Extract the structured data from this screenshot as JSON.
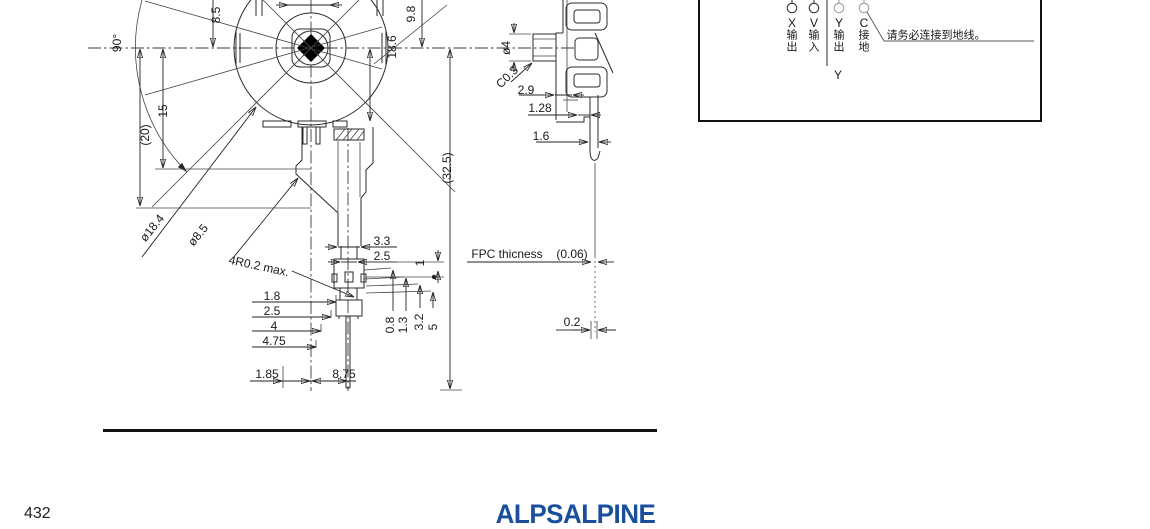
{
  "page": {
    "number": "432",
    "brand": "ALPSALPINE"
  },
  "front_view": {
    "dims": {
      "d85": "8.5",
      "a90": "90°",
      "d15": "15",
      "d20": "(20)",
      "dia1": "ø18.4",
      "dia2": "ø8.5",
      "d98": "9.8",
      "d186": "18.6",
      "d325": "(32.5)",
      "d33": "3.3",
      "d25a": "2.5",
      "r4": "4R0.2 max.",
      "d18": "1.8",
      "d25b": "2.5",
      "d4": "4",
      "d475": "4.75",
      "d185": "1.85",
      "d875": "8.75",
      "d1": "1",
      "d08": "0.8",
      "d13": "1.3",
      "d32": "3.2",
      "d5": "5"
    }
  },
  "side_view": {
    "dims": {
      "dia4": "ø4",
      "c03": "C0.3",
      "d29": "2.9",
      "d128": "1.28",
      "d16": "1.6",
      "d02": "0.2"
    },
    "fpc": {
      "label": "FPC thicness",
      "value": "(0.06)"
    }
  },
  "circuit": {
    "terminals": [
      {
        "letter": "X",
        "label": "输出"
      },
      {
        "letter": "V",
        "label": "输入"
      },
      {
        "letter": "Y",
        "label": "输出"
      },
      {
        "letter": "C",
        "label": "接地"
      }
    ],
    "note": "请务必连接到地线。",
    "axis": "Y"
  }
}
